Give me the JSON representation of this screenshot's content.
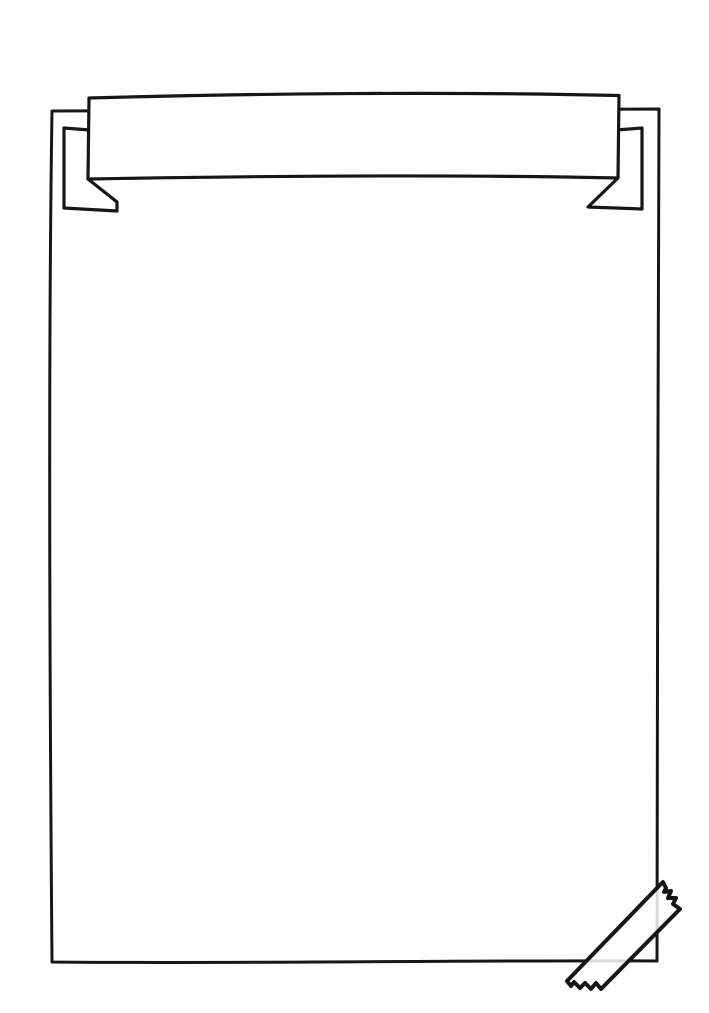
{
  "scene": {
    "banner_text": "",
    "page_text": ""
  },
  "colors": {
    "background": "#ffffff",
    "line": "#161616",
    "paper": "#ffffff",
    "tape_opacity": "0.84"
  },
  "icons": {
    "poster": "blank-poster-paper",
    "banner": "ribbon-banner",
    "tape": "washi-tape-strip"
  }
}
